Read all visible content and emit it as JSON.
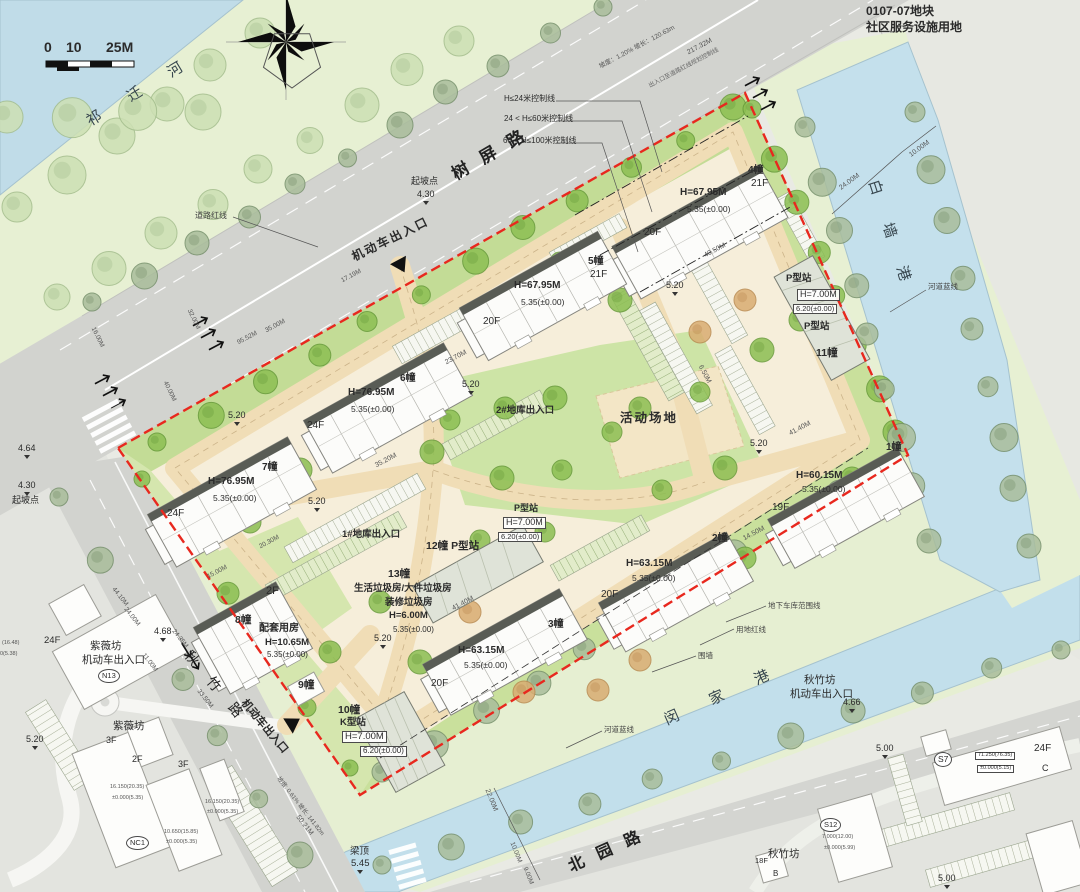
{
  "map_colors": {
    "boundary_red": "#e8281e",
    "water": "#c2deea",
    "site_base": "#f6eeda",
    "road_gray": "#d2d3cf",
    "lawn_green": "#cde4a6",
    "bank_green": "#e7f0d3"
  },
  "labels": [
    {
      "n": "scale-0",
      "t": "0",
      "x": 44,
      "y": 40,
      "s": 14,
      "w": 1
    },
    {
      "n": "scale-10",
      "t": "10",
      "x": 66,
      "y": 40,
      "s": 14,
      "w": 1
    },
    {
      "n": "scale-25m",
      "t": "25M",
      "x": 106,
      "y": 40,
      "s": 14,
      "w": 1
    },
    {
      "n": "river-qiqian-name",
      "t": "祁 迁 河",
      "x": 84,
      "y": 116,
      "r": -31,
      "s": 15,
      "ls": 14,
      "c": "#37464e"
    },
    {
      "n": "road-shuping-name",
      "t": "树 屏 路",
      "x": 449,
      "y": 168,
      "r": -30,
      "s": 17,
      "ls": 5,
      "w": 1,
      "c": "#222"
    },
    {
      "n": "ctrl-line-24",
      "t": "H≤24米控制线",
      "x": 504,
      "y": 95,
      "s": 8
    },
    {
      "n": "ctrl-line-60",
      "t": "24 < H≤60米控制线",
      "x": 504,
      "y": 115,
      "s": 8
    },
    {
      "n": "ctrl-line-100",
      "t": "60 < H≤100米控制线",
      "x": 503,
      "y": 137,
      "s": 8
    },
    {
      "n": "qipodian-top",
      "t": "起坡点",
      "x": 411,
      "y": 177,
      "s": 9
    },
    {
      "n": "qipodian-top-val",
      "t": "4.30",
      "x": 417,
      "y": 190,
      "s": 9,
      "m": 1
    },
    {
      "n": "dim-217",
      "t": "217.32M",
      "x": 686,
      "y": 50,
      "r": -28,
      "s": 7,
      "c": "#555"
    },
    {
      "n": "dim-slope-top",
      "t": "坡度：1.20% 坡长：120.63m",
      "x": 598,
      "y": 64,
      "r": -28,
      "s": 6.5,
      "c": "#555"
    },
    {
      "n": "note-redline-ctrl",
      "t": "出入口至道路红线规划控制线",
      "x": 648,
      "y": 84,
      "r": -28,
      "s": 6,
      "c": "#666"
    },
    {
      "n": "plot-code",
      "t": "0107-07地块",
      "x": 866,
      "y": 5,
      "s": 12,
      "w": 1
    },
    {
      "n": "plot-use",
      "t": "社区服务设施用地",
      "x": 866,
      "y": 21,
      "s": 12,
      "w": 1
    },
    {
      "n": "entrance-top-label",
      "t": "机动车出入口",
      "x": 350,
      "y": 252,
      "r": -26,
      "s": 12,
      "w": 1,
      "ls": 2
    },
    {
      "n": "note-daolu-hongxian",
      "t": "道路红线",
      "x": 195,
      "y": 212,
      "s": 8,
      "c": "#444"
    },
    {
      "n": "river-baiqiang-name",
      "t": "白 墙 港",
      "x": 880,
      "y": 178,
      "r": 72,
      "s": 15,
      "ls": 13,
      "c": "#37464e"
    },
    {
      "n": "note-hedao-lanxian-e",
      "t": "河道蓝线",
      "x": 928,
      "y": 283,
      "s": 7.5,
      "c": "#444"
    },
    {
      "n": "dim-24m-e",
      "t": "24.00M",
      "x": 838,
      "y": 186,
      "r": -36,
      "s": 7,
      "c": "#555"
    },
    {
      "n": "dim-10m-e",
      "t": "10.00M",
      "x": 908,
      "y": 153,
      "r": -36,
      "s": 7,
      "c": "#555"
    },
    {
      "n": "b4-num",
      "t": "4幢",
      "x": 748,
      "y": 166,
      "s": 10,
      "w": 1
    },
    {
      "n": "b4-floors",
      "t": "21F",
      "x": 751,
      "y": 179,
      "s": 10
    },
    {
      "n": "b4-height",
      "t": "H=67.95M",
      "x": 680,
      "y": 188,
      "s": 10,
      "w": 1
    },
    {
      "n": "b4-level",
      "t": "5.35(±0.00)",
      "x": 687,
      "y": 205,
      "s": 8.5
    },
    {
      "n": "b4-floors2",
      "t": "20F",
      "x": 644,
      "y": 228,
      "s": 10
    },
    {
      "n": "b5-num",
      "t": "5幢",
      "x": 588,
      "y": 257,
      "s": 10,
      "w": 1
    },
    {
      "n": "b5-floors",
      "t": "21F",
      "x": 590,
      "y": 270,
      "s": 10
    },
    {
      "n": "b5-height",
      "t": "H=67.95M",
      "x": 514,
      "y": 281,
      "s": 10,
      "w": 1
    },
    {
      "n": "b5-level",
      "t": "5.35(±0.00)",
      "x": 521,
      "y": 298,
      "s": 8.5
    },
    {
      "n": "b5-floors2",
      "t": "20F",
      "x": 483,
      "y": 317,
      "s": 10
    },
    {
      "n": "b6-num",
      "t": "6幢",
      "x": 400,
      "y": 374,
      "s": 10,
      "w": 1
    },
    {
      "n": "b6-height",
      "t": "H=76.95M",
      "x": 348,
      "y": 388,
      "s": 10,
      "w": 1
    },
    {
      "n": "b6-level",
      "t": "5.35(±0.00)",
      "x": 351,
      "y": 405,
      "s": 8.5
    },
    {
      "n": "b6-floors",
      "t": "24F",
      "x": 307,
      "y": 421,
      "s": 10
    },
    {
      "n": "b7-num",
      "t": "7幢",
      "x": 262,
      "y": 463,
      "s": 10,
      "w": 1
    },
    {
      "n": "b7-height",
      "t": "H=76.95M",
      "x": 208,
      "y": 477,
      "s": 10,
      "w": 1
    },
    {
      "n": "b7-level",
      "t": "5.35(±0.00)",
      "x": 213,
      "y": 494,
      "s": 8.5
    },
    {
      "n": "b7-floors",
      "t": "24F",
      "x": 167,
      "y": 509,
      "s": 10
    },
    {
      "n": "b3-num",
      "t": "3幢",
      "x": 548,
      "y": 620,
      "s": 10,
      "w": 1
    },
    {
      "n": "b3-height",
      "t": "H=63.15M",
      "x": 458,
      "y": 646,
      "s": 10,
      "w": 1
    },
    {
      "n": "b3-level",
      "t": "5.35(±0.00)",
      "x": 464,
      "y": 661,
      "s": 8.5
    },
    {
      "n": "b3-floors",
      "t": "20F",
      "x": 431,
      "y": 679,
      "s": 10
    },
    {
      "n": "b2-num",
      "t": "2幢",
      "x": 712,
      "y": 534,
      "s": 10,
      "w": 1
    },
    {
      "n": "b2-height",
      "t": "H=63.15M",
      "x": 626,
      "y": 559,
      "s": 10,
      "w": 1
    },
    {
      "n": "b2-level",
      "t": "5.35(±0.00)",
      "x": 632,
      "y": 574,
      "s": 8.5
    },
    {
      "n": "b2-floors",
      "t": "20F",
      "x": 601,
      "y": 590,
      "s": 10
    },
    {
      "n": "b1-num",
      "t": "1幢",
      "x": 886,
      "y": 443,
      "s": 10,
      "w": 1
    },
    {
      "n": "b1-height",
      "t": "H=60.15M",
      "x": 796,
      "y": 471,
      "s": 10,
      "w": 1
    },
    {
      "n": "b1-level",
      "t": "5.35(±0.00)",
      "x": 802,
      "y": 485,
      "s": 8.5
    },
    {
      "n": "b1-floors",
      "t": "19F",
      "x": 772,
      "y": 503,
      "s": 10
    },
    {
      "n": "st11-type-a",
      "t": "P型站",
      "x": 786,
      "y": 274,
      "s": 9.5,
      "w": 1
    },
    {
      "n": "st11-height",
      "t": "H=7.00M",
      "x": 797,
      "y": 289,
      "s": 9,
      "box": 1
    },
    {
      "n": "st11-level",
      "t": "6.20(±0.00)",
      "x": 793,
      "y": 304,
      "s": 7.5,
      "box": 1
    },
    {
      "n": "st11-type-b",
      "t": "P型站",
      "x": 804,
      "y": 322,
      "s": 9.5,
      "w": 1
    },
    {
      "n": "st11-num",
      "t": "11幢",
      "x": 816,
      "y": 348,
      "s": 10.5,
      "w": 1
    },
    {
      "n": "st12-num",
      "t": "12幢 P型站",
      "x": 426,
      "y": 541,
      "s": 10.5,
      "w": 1
    },
    {
      "n": "stP-type",
      "t": "P型站",
      "x": 514,
      "y": 504,
      "s": 9,
      "w": 1
    },
    {
      "n": "stP-height",
      "t": "H=7.00M",
      "x": 503,
      "y": 517,
      "s": 9,
      "box": 1
    },
    {
      "n": "stP-level",
      "t": "6.20(±0.00)",
      "x": 498,
      "y": 532,
      "s": 7.5,
      "box": 1
    },
    {
      "n": "b13-num",
      "t": "13幢",
      "x": 388,
      "y": 569,
      "s": 10.5,
      "w": 1
    },
    {
      "n": "b13-use1",
      "t": "生活垃圾房/大件垃圾房",
      "x": 354,
      "y": 584,
      "s": 9.5,
      "w": 1
    },
    {
      "n": "b13-use2",
      "t": "装修垃圾房",
      "x": 385,
      "y": 598,
      "s": 9.5,
      "w": 1
    },
    {
      "n": "b13-height",
      "t": "H=6.00M",
      "x": 389,
      "y": 611,
      "s": 9.5,
      "w": 1
    },
    {
      "n": "b13-level",
      "t": "5.35(±0.00)",
      "x": 393,
      "y": 626,
      "s": 8
    },
    {
      "n": "b8-floors",
      "t": "2F",
      "x": 266,
      "y": 586,
      "s": 11
    },
    {
      "n": "b8-num",
      "t": "8幢",
      "x": 235,
      "y": 615,
      "s": 10.5,
      "w": 1
    },
    {
      "n": "b8-use",
      "t": "配套用房",
      "x": 259,
      "y": 624,
      "s": 10,
      "w": 1
    },
    {
      "n": "b8-height",
      "t": "H=10.65M",
      "x": 265,
      "y": 638,
      "s": 9.5,
      "w": 1
    },
    {
      "n": "b8-level",
      "t": "5.35(±0.00)",
      "x": 267,
      "y": 651,
      "s": 8
    },
    {
      "n": "b9-num",
      "t": "9幢",
      "x": 298,
      "y": 680,
      "s": 10.5,
      "w": 1
    },
    {
      "n": "b10-num",
      "t": "10幢",
      "x": 338,
      "y": 705,
      "s": 10.5,
      "w": 1
    },
    {
      "n": "b10-type",
      "t": "K型站",
      "x": 340,
      "y": 718,
      "s": 9.5,
      "w": 1
    },
    {
      "n": "b10-height",
      "t": "H=7.00M",
      "x": 342,
      "y": 731,
      "s": 9.5,
      "box": 1
    },
    {
      "n": "b10-level",
      "t": "6.20(±0.00)",
      "x": 360,
      "y": 746,
      "s": 8,
      "box": 1
    },
    {
      "n": "huodong-changdi",
      "t": "活动场地",
      "x": 620,
      "y": 412,
      "s": 12.5,
      "w": 1,
      "ls": 2
    },
    {
      "n": "garage-exit-2",
      "t": "2#地库出入口",
      "x": 496,
      "y": 406,
      "s": 9.5,
      "w": 1
    },
    {
      "n": "garage-exit-1",
      "t": "1#地库出入口",
      "x": 342,
      "y": 530,
      "s": 9.5,
      "w": 1
    },
    {
      "n": "spot-520-a",
      "t": "5.20",
      "x": 666,
      "y": 281,
      "s": 9,
      "m": 1
    },
    {
      "n": "spot-520-b",
      "t": "5.20",
      "x": 462,
      "y": 380,
      "s": 9,
      "m": 1
    },
    {
      "n": "spot-520-c",
      "t": "5.20",
      "x": 308,
      "y": 497,
      "s": 9,
      "m": 1
    },
    {
      "n": "spot-520-d",
      "t": "5.20",
      "x": 374,
      "y": 634,
      "s": 9,
      "m": 1
    },
    {
      "n": "spot-520-e",
      "t": "5.20",
      "x": 750,
      "y": 439,
      "s": 9,
      "m": 1
    },
    {
      "n": "spot-520-f",
      "t": "5.20",
      "x": 228,
      "y": 411,
      "s": 9,
      "m": 1
    },
    {
      "n": "dim-4050",
      "t": "40.50M",
      "x": 703,
      "y": 253,
      "r": -28,
      "s": 7,
      "c": "#555"
    },
    {
      "n": "dim-2370",
      "t": "23.70M",
      "x": 444,
      "y": 360,
      "r": -28,
      "s": 7,
      "c": "#555"
    },
    {
      "n": "dim-3520",
      "t": "35.20M",
      "x": 374,
      "y": 463,
      "r": -28,
      "s": 7,
      "c": "#555"
    },
    {
      "n": "dim-4140-a",
      "t": "41.40M",
      "x": 451,
      "y": 606,
      "r": -28,
      "s": 7,
      "c": "#555"
    },
    {
      "n": "dim-4140-b",
      "t": "41.40M",
      "x": 788,
      "y": 431,
      "r": -28,
      "s": 7,
      "c": "#555"
    },
    {
      "n": "dim-1450",
      "t": "14.50M",
      "x": 742,
      "y": 536,
      "r": -28,
      "s": 7,
      "c": "#555"
    },
    {
      "n": "dim-650",
      "t": "6.50M",
      "x": 703,
      "y": 364,
      "r": 62,
      "s": 7,
      "c": "#555"
    },
    {
      "n": "dim-2030",
      "t": "20.30M",
      "x": 258,
      "y": 544,
      "r": -28,
      "s": 6.5,
      "c": "#555"
    },
    {
      "n": "dim-1500",
      "t": "15.00M",
      "x": 206,
      "y": 574,
      "r": -28,
      "s": 6.5,
      "c": "#555"
    },
    {
      "n": "dim-1719",
      "t": "17.19M",
      "x": 340,
      "y": 278,
      "r": -28,
      "s": 6.5,
      "c": "#555"
    },
    {
      "n": "dim-3500",
      "t": "35.00M",
      "x": 264,
      "y": 328,
      "r": -28,
      "s": 6.5,
      "c": "#555"
    },
    {
      "n": "dim-9552",
      "t": "95.52M",
      "x": 236,
      "y": 340,
      "r": -28,
      "s": 6.5,
      "c": "#555"
    },
    {
      "n": "dim-3200",
      "t": "32.00M",
      "x": 192,
      "y": 308,
      "r": 64,
      "s": 6.5,
      "c": "#555"
    },
    {
      "n": "dim-1600",
      "t": "16.00M",
      "x": 96,
      "y": 326,
      "r": 64,
      "s": 6.5,
      "c": "#555"
    },
    {
      "n": "dim-4000",
      "t": "40.00M",
      "x": 168,
      "y": 380,
      "r": 64,
      "s": 6.5,
      "c": "#555"
    },
    {
      "n": "spot-464",
      "t": "4.64",
      "x": 18,
      "y": 444,
      "s": 9,
      "m": 1
    },
    {
      "n": "spot-430-left",
      "t": "4.30",
      "x": 18,
      "y": 481,
      "s": 9,
      "m": 1
    },
    {
      "n": "qipodian-left",
      "t": "起坡点",
      "x": 12,
      "y": 496,
      "s": 9
    },
    {
      "n": "ziweifang-label",
      "t": "紫薇坊",
      "x": 90,
      "y": 641,
      "s": 10.5
    },
    {
      "n": "ziweifang-entrance",
      "t": "机动车出入口",
      "x": 82,
      "y": 655,
      "s": 10.5
    },
    {
      "n": "badge-n13",
      "t": "N13",
      "x": 98,
      "y": 669,
      "s": 7.5,
      "circ": 1
    },
    {
      "n": "offsite-24f-w",
      "t": "24F",
      "x": 44,
      "y": 636,
      "s": 9.5
    },
    {
      "n": "offsite-val-1648",
      "t": "(16.48)",
      "x": 2,
      "y": 641,
      "s": 5.5,
      "c": "#555"
    },
    {
      "n": "offsite-val-538",
      "t": "0(5.38)",
      "x": 0,
      "y": 652,
      "s": 5.5,
      "c": "#555"
    },
    {
      "n": "ziweifang-label-2",
      "t": "紫薇坊",
      "x": 113,
      "y": 721,
      "s": 10.5
    },
    {
      "n": "offsite-3f-a",
      "t": "3F",
      "x": 106,
      "y": 736,
      "s": 9
    },
    {
      "n": "spot-520-g",
      "t": "5.20",
      "x": 26,
      "y": 735,
      "s": 9,
      "m": 1
    },
    {
      "n": "offsite-2f",
      "t": "2F",
      "x": 132,
      "y": 755,
      "s": 9
    },
    {
      "n": "offsite-3f-b",
      "t": "3F",
      "x": 178,
      "y": 760,
      "s": 9
    },
    {
      "n": "badge-nc1",
      "t": "NC1",
      "x": 126,
      "y": 836,
      "s": 7.5,
      "circ": 1
    },
    {
      "n": "offsite-val-16150-a",
      "t": "16.150(20.35)",
      "x": 110,
      "y": 785,
      "s": 5.5,
      "c": "#555"
    },
    {
      "n": "offsite-val-0000-a",
      "t": "±0.000(5.35)",
      "x": 112,
      "y": 796,
      "s": 5.5,
      "c": "#555"
    },
    {
      "n": "offsite-val-16150-b",
      "t": "16.150(20.35)",
      "x": 205,
      "y": 800,
      "s": 5.5,
      "c": "#555"
    },
    {
      "n": "offsite-val-0000-b",
      "t": "±0.000(5.35)",
      "x": 207,
      "y": 810,
      "s": 5.5,
      "c": "#555"
    },
    {
      "n": "offsite-val-10650",
      "t": "10.650(15.85)",
      "x": 164,
      "y": 830,
      "s": 5.5,
      "c": "#555"
    },
    {
      "n": "offsite-val-0000-c",
      "t": "±0.000(5.35)",
      "x": 166,
      "y": 840,
      "s": 5.5,
      "c": "#555"
    },
    {
      "n": "road-qiuzhu-name",
      "t": "秋 竹 路",
      "x": 193,
      "y": 648,
      "r": 50,
      "s": 14,
      "ls": 8,
      "c": "#222"
    },
    {
      "n": "entrance-sw-label",
      "t": "机动车出入口",
      "x": 247,
      "y": 698,
      "r": 50,
      "s": 11,
      "w": 1
    },
    {
      "n": "spot-468",
      "t": "4.68",
      "x": 154,
      "y": 627,
      "s": 9,
      "m": 1
    },
    {
      "n": "dim-1100-sw",
      "t": "11.00M",
      "x": 146,
      "y": 652,
      "r": 52,
      "s": 6.5,
      "c": "#555"
    },
    {
      "n": "dim-2435",
      "t": "24.35M",
      "x": 176,
      "y": 628,
      "r": 52,
      "s": 6.5,
      "c": "#555"
    },
    {
      "n": "dim-3350",
      "t": "33.50M",
      "x": 201,
      "y": 688,
      "r": 52,
      "s": 6.5,
      "c": "#555"
    },
    {
      "n": "dim-4410",
      "t": "44.10M",
      "x": 116,
      "y": 586,
      "r": 52,
      "s": 6.5,
      "c": "#555"
    },
    {
      "n": "dim-2400-sw",
      "t": "24.00M",
      "x": 128,
      "y": 606,
      "r": 52,
      "s": 6.5,
      "c": "#555"
    },
    {
      "n": "dim-5021",
      "t": "50.21M",
      "x": 300,
      "y": 814,
      "r": 52,
      "s": 7,
      "c": "#555"
    },
    {
      "n": "dim-slope-bottom",
      "t": "坡度: 0.61% 坡长: 141.82m",
      "x": 280,
      "y": 776,
      "r": 52,
      "s": 6,
      "c": "#555"
    },
    {
      "n": "liangding",
      "t": "梁顶",
      "x": 350,
      "y": 847,
      "s": 9.5
    },
    {
      "n": "liangding-val",
      "t": "5.45",
      "x": 351,
      "y": 859,
      "s": 9.5,
      "m": 1
    },
    {
      "n": "road-beiyuan-name",
      "t": "北 园 路",
      "x": 566,
      "y": 860,
      "r": -24,
      "s": 16,
      "ls": 5,
      "w": 1,
      "c": "#222"
    },
    {
      "n": "river-minjia-name",
      "t": "闵 家 港",
      "x": 662,
      "y": 714,
      "r": -24,
      "s": 15,
      "ls": 15,
      "c": "#37464e"
    },
    {
      "n": "note-hedao-lanxian-s",
      "t": "河道蓝线",
      "x": 604,
      "y": 726,
      "s": 7.5,
      "c": "#444"
    },
    {
      "n": "note-weiqiang",
      "t": "围墙",
      "x": 698,
      "y": 652,
      "s": 7.5,
      "c": "#444"
    },
    {
      "n": "note-yongdi-hongxian",
      "t": "用地红线",
      "x": 736,
      "y": 626,
      "s": 7.5,
      "c": "#444"
    },
    {
      "n": "note-garage-extent",
      "t": "地下车库范围线",
      "x": 768,
      "y": 602,
      "s": 7.5,
      "c": "#444"
    },
    {
      "n": "qiuzhufang-label",
      "t": "秋竹坊",
      "x": 804,
      "y": 675,
      "s": 10.5
    },
    {
      "n": "qiuzhufang-entrance",
      "t": "机动车出入口",
      "x": 790,
      "y": 689,
      "s": 10.5
    },
    {
      "n": "spot-466",
      "t": "4.66",
      "x": 843,
      "y": 698,
      "s": 9,
      "m": 1
    },
    {
      "n": "dim-2200",
      "t": "22.00M",
      "x": 490,
      "y": 788,
      "r": 68,
      "s": 7,
      "c": "#555"
    },
    {
      "n": "dim-1000-s",
      "t": "10.00M",
      "x": 515,
      "y": 841,
      "r": 68,
      "s": 6.5,
      "c": "#555"
    },
    {
      "n": "dim-900-s",
      "t": "9.00M",
      "x": 528,
      "y": 866,
      "r": 68,
      "s": 6.5,
      "c": "#555"
    },
    {
      "n": "badge-s7",
      "t": "S7",
      "x": 934,
      "y": 752,
      "s": 8.5,
      "circ": 1
    },
    {
      "n": "offsite-24f-e",
      "t": "24F",
      "x": 1034,
      "y": 744,
      "s": 10
    },
    {
      "n": "offsite-val-71250",
      "t": "71.250(76.35)",
      "x": 975,
      "y": 752,
      "s": 5.5,
      "box": 1
    },
    {
      "n": "offsite-val-0000-d",
      "t": "±0.000(5.15)",
      "x": 977,
      "y": 765,
      "s": 5.5,
      "box": 1
    },
    {
      "n": "offsite-c",
      "t": "C",
      "x": 1042,
      "y": 764,
      "s": 9
    },
    {
      "n": "badge-s12",
      "t": "S12",
      "x": 820,
      "y": 818,
      "s": 7.5,
      "circ": 1
    },
    {
      "n": "offsite-val-7000",
      "t": "7.000(12.00)",
      "x": 822,
      "y": 835,
      "s": 5.5,
      "c": "#555"
    },
    {
      "n": "offsite-val-0000-e",
      "t": "±0.000(5.99)",
      "x": 824,
      "y": 846,
      "s": 5.5,
      "c": "#555"
    },
    {
      "n": "spot-500-a",
      "t": "5.00",
      "x": 876,
      "y": 744,
      "s": 9,
      "m": 1
    },
    {
      "n": "spot-500-b",
      "t": "5.00",
      "x": 938,
      "y": 874,
      "s": 9,
      "m": 1
    },
    {
      "n": "qiuzhufang-se",
      "t": "秋竹坊",
      "x": 768,
      "y": 849,
      "s": 10.5
    },
    {
      "n": "offsite-18f",
      "t": "18F",
      "x": 755,
      "y": 857,
      "s": 7.5
    },
    {
      "n": "offsite-b",
      "t": "B",
      "x": 773,
      "y": 870,
      "s": 8
    }
  ]
}
